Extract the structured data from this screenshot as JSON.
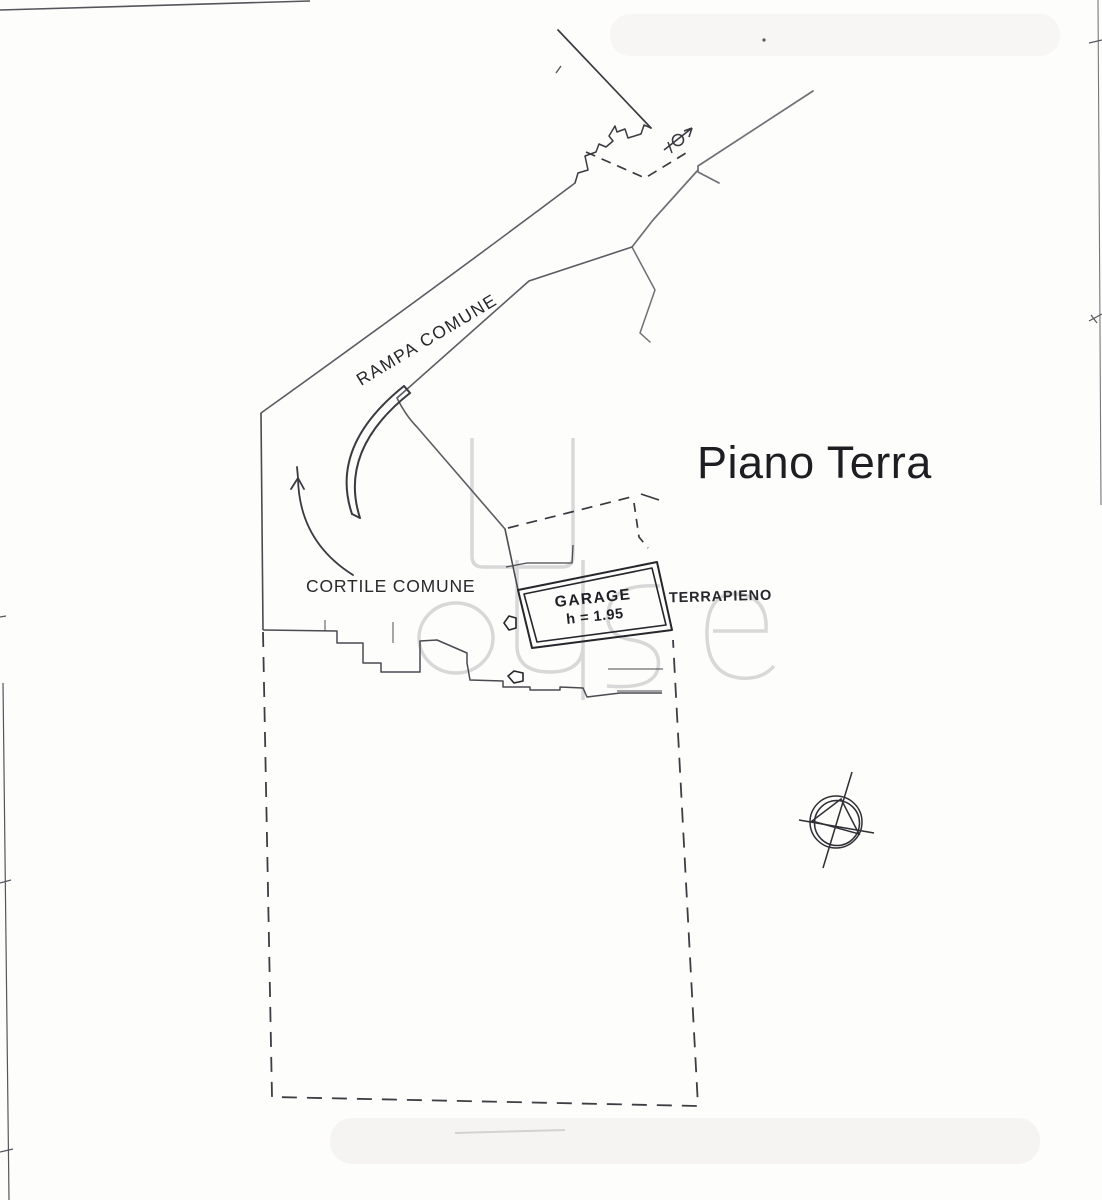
{
  "title": "Piano Terra",
  "labels": {
    "ramp": "RAMPA COMUNE",
    "courtyard": "CORTILE COMUNE",
    "garage": "GARAGE",
    "garage_height": "h = 1.95",
    "embankment": "TERRAPIENO"
  },
  "watermark": "House",
  "symbols": [
    "benchmark-circle-symbol",
    "door-swing-arrow",
    "ramp-direction-arrow",
    "north-reference-arrow"
  ],
  "colors": {
    "ink": "#2f2f35",
    "light_ink": "#77777e",
    "watermark": "#d2d2d2",
    "paper": "#fdfdfc"
  }
}
